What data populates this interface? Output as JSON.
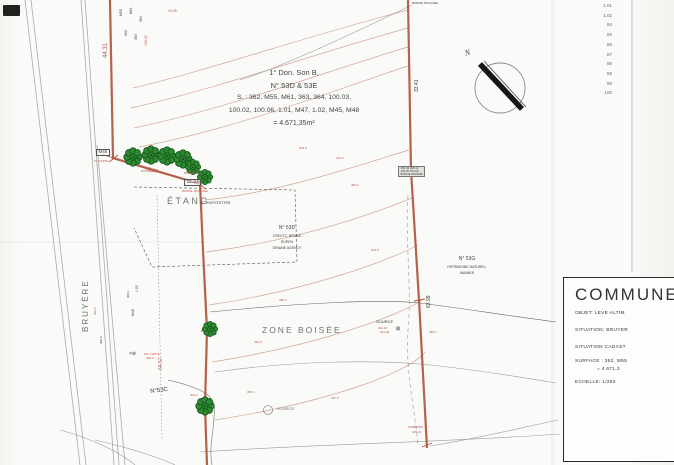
{
  "colors": {
    "boundary": "#b0543e",
    "tree_fill": "#2e8a32",
    "tree_edge": "#145418",
    "red": "#bf5348",
    "ink": "#3b3b3b",
    "gray": "#707070",
    "contour": "#d4a592",
    "paper": "#fafaf8"
  },
  "parcel_note": {
    "l1": "1° Don. Son B,",
    "l2": "N° 53D & 53E",
    "l3": "S. : 362, M55, M61, 363, 364, 100.03,",
    "l4": "100.02, 100.06, 1.01, M47, 1.02, M45, M48",
    "l5": "= 4.671,35m²"
  },
  "title_block": {
    "commune": "COMMUNE",
    "objet": "OBJET: LEVE ALTIM",
    "situation": "SITUATION: BRUYER",
    "cadastre": "SITUATION CADAST",
    "surface": "SURFACE : 362, M55",
    "surface2": "= 4.671,3",
    "echelle": "ECHELLE: 1/250"
  },
  "right_column": [
    "1.01",
    "1.02",
    "84",
    "85",
    "86",
    "87",
    "88",
    "89",
    "90",
    "100"
  ],
  "north_label": "N",
  "point_labels": [
    {
      "t": "44.31",
      "x": 103,
      "y": 58,
      "s": 6,
      "c": "red",
      "r": -90
    },
    {
      "t": "M55",
      "x": 120,
      "y": 16,
      "s": 3.5,
      "c": "ink",
      "r": -90
    },
    {
      "t": "362",
      "x": 125,
      "y": 36,
      "s": 3.5,
      "c": "ink",
      "r": -90
    },
    {
      "t": "M61",
      "x": 130,
      "y": 14,
      "s": 3.5,
      "c": "ink",
      "r": -90
    },
    {
      "t": "363",
      "x": 135,
      "y": 40,
      "s": 3.5,
      "c": "ink",
      "r": -90
    },
    {
      "t": "364",
      "x": 140,
      "y": 22,
      "s": 3.5,
      "c": "ink",
      "r": -90
    },
    {
      "t": "100.02",
      "x": 145,
      "y": 46,
      "s": 3.5,
      "c": "red",
      "r": -90
    },
    {
      "t": "44.05",
      "x": 168,
      "y": 10,
      "s": 3.5,
      "c": "red"
    },
    {
      "t": "15.22",
      "x": 146,
      "y": 167,
      "s": 5,
      "c": "red",
      "r": 14
    },
    {
      "t": "11.32",
      "x": 184,
      "y": 179,
      "s": 5,
      "c": "ink",
      "box": true
    },
    {
      "t": "BORNE TROUVÉE",
      "x": 182,
      "y": 190,
      "s": 3,
      "c": "red"
    },
    {
      "t": "BOULEAU",
      "x": 141,
      "y": 170,
      "s": 3,
      "c": "red"
    },
    {
      "t": "BOULEAU",
      "x": 184,
      "y": 172,
      "s": 3,
      "c": "red"
    },
    {
      "t": "M45",
      "x": 96,
      "y": 149,
      "s": 4.5,
      "c": "ink",
      "box": true
    },
    {
      "t": "PT LIMITE",
      "x": 94,
      "y": 160,
      "s": 3,
      "c": "red"
    },
    {
      "t": "ÉTANG",
      "x": 167,
      "y": 197,
      "s": 9,
      "c": "gray",
      "ls": 2.5
    },
    {
      "t": "◻",
      "x": 200,
      "y": 201,
      "s": 4,
      "c": "ink"
    },
    {
      "t": "HOFSTETTER",
      "x": 207,
      "y": 202,
      "s": 3.5,
      "c": "ink"
    },
    {
      "t": "BORNE TROUVÉE",
      "x": 412,
      "y": 2,
      "s": 3,
      "c": "ink"
    },
    {
      "t": "33.41",
      "x": 415,
      "y": 92,
      "s": 5,
      "c": "ink",
      "r": -90
    },
    {
      "t": "100.03 395.12\n100.06 394.90\nBORNE REPÈRE",
      "x": 398,
      "y": 166,
      "s": 2.8,
      "c": "ink",
      "box": true,
      "bg": true
    },
    {
      "t": "63.99",
      "x": 427,
      "y": 308,
      "s": 5,
      "c": "ink",
      "r": -90
    },
    {
      "t": "64.57",
      "x": 159,
      "y": 370,
      "s": 5,
      "c": "red",
      "r": -90
    },
    {
      "t": "N° 53G",
      "x": 467,
      "y": 257,
      "s": 5,
      "c": "ink",
      "a": "m"
    },
    {
      "t": "PATRIMOINE NATUREL,",
      "x": 467,
      "y": 266,
      "s": 3.5,
      "c": "ink",
      "a": "m"
    },
    {
      "t": "WAIMES",
      "x": 467,
      "y": 272,
      "s": 3.5,
      "c": "ink",
      "a": "m"
    },
    {
      "t": "N° 53D",
      "x": 287,
      "y": 226,
      "s": 5,
      "c": "ink",
      "a": "m"
    },
    {
      "t": "CREUTZ, BRUNO",
      "x": 287,
      "y": 235,
      "s": 3.5,
      "c": "ink",
      "a": "m"
    },
    {
      "t": "EUPEN",
      "x": 287,
      "y": 241,
      "s": 3.5,
      "c": "ink",
      "a": "m"
    },
    {
      "t": "ORIANE AGENCY",
      "x": 287,
      "y": 247,
      "s": 3.5,
      "c": "ink",
      "a": "m"
    },
    {
      "t": "ZONE BOISÉE",
      "x": 262,
      "y": 326,
      "s": 8.5,
      "c": "gray",
      "ls": 2
    },
    {
      "t": "SOURCE",
      "x": 277,
      "y": 407,
      "s": 4,
      "c": "gray"
    },
    {
      "t": "SOURCE",
      "x": 376,
      "y": 320,
      "s": 4,
      "c": "ink"
    },
    {
      "t": "402.16",
      "x": 378,
      "y": 327,
      "s": 3,
      "c": "red"
    },
    {
      "t": "401.90",
      "x": 380,
      "y": 331,
      "s": 3,
      "c": "red"
    },
    {
      "t": "⊠",
      "x": 396,
      "y": 327,
      "s": 5,
      "c": "ink"
    },
    {
      "t": "N°53C",
      "x": 150,
      "y": 389,
      "s": 6,
      "c": "ink",
      "r": -7
    },
    {
      "t": "403.2",
      "x": 190,
      "y": 394,
      "s": 3,
      "c": "red"
    },
    {
      "t": "AUBÉPINE",
      "x": 408,
      "y": 426,
      "s": 3,
      "c": "red"
    },
    {
      "t": "425.16",
      "x": 412,
      "y": 431,
      "s": 3,
      "c": "red"
    },
    {
      "t": "401.3",
      "x": 336,
      "y": 157,
      "s": 3,
      "c": "red"
    },
    {
      "t": "403.6",
      "x": 299,
      "y": 147,
      "s": 3,
      "c": "red"
    },
    {
      "t": "405.2",
      "x": 351,
      "y": 184,
      "s": 3,
      "c": "red"
    },
    {
      "t": "404.8",
      "x": 371,
      "y": 249,
      "s": 3,
      "c": "red"
    },
    {
      "t": "398.4",
      "x": 279,
      "y": 299,
      "s": 3,
      "c": "red"
    },
    {
      "t": "396.8",
      "x": 254,
      "y": 341,
      "s": 3,
      "c": "red"
    },
    {
      "t": "395.1",
      "x": 247,
      "y": 391,
      "s": 3,
      "c": "red"
    },
    {
      "t": "397.5",
      "x": 331,
      "y": 397,
      "s": 3,
      "c": "red"
    },
    {
      "t": "399.2",
      "x": 429,
      "y": 331,
      "s": 3,
      "c": "red"
    },
    {
      "t": "409.5",
      "x": 94,
      "y": 315,
      "s": 3,
      "c": "red",
      "r": -90
    },
    {
      "t": "408.9",
      "x": 100,
      "y": 344,
      "s": 3,
      "c": "ink",
      "r": -90
    },
    {
      "t": "406.1",
      "x": 127,
      "y": 298,
      "s": 3,
      "c": "ink",
      "r": -90
    },
    {
      "t": "M48",
      "x": 132,
      "y": 316,
      "s": 3.5,
      "c": "ink",
      "r": -90
    },
    {
      "t": "1.02",
      "x": 136,
      "y": 292,
      "s": 3.5,
      "c": "ink",
      "r": -90
    },
    {
      "t": "P.E. LIMITE",
      "x": 144,
      "y": 353,
      "s": 3,
      "c": "red"
    },
    {
      "t": "408.2",
      "x": 146,
      "y": 357,
      "s": 3,
      "c": "red"
    },
    {
      "t": "×⊚",
      "x": 129,
      "y": 352,
      "s": 5,
      "c": "ink"
    },
    {
      "t": "BRUYÈRE",
      "x": 82,
      "y": 332,
      "s": 8,
      "c": "gray",
      "r": -90,
      "ls": 2
    },
    {
      "t": "408",
      "x": 598,
      "y": 410,
      "s": 3,
      "c": "gray"
    },
    {
      "t": "405",
      "x": 645,
      "y": 406,
      "s": 3,
      "c": "gray"
    },
    {
      "t": "N",
      "x": 464,
      "y": 50,
      "s": 8,
      "c": "ink",
      "r": -15,
      "serif": true
    }
  ],
  "trees": [
    {
      "x": 133,
      "y": 157,
      "r": 9
    },
    {
      "x": 151,
      "y": 155,
      "r": 9
    },
    {
      "x": 167,
      "y": 156,
      "r": 9
    },
    {
      "x": 183,
      "y": 159,
      "r": 9
    },
    {
      "x": 193,
      "y": 167,
      "r": 7.5
    },
    {
      "x": 205,
      "y": 177,
      "r": 7.5
    },
    {
      "x": 210,
      "y": 329,
      "r": 7.5
    },
    {
      "x": 205,
      "y": 406,
      "r": 9
    }
  ]
}
